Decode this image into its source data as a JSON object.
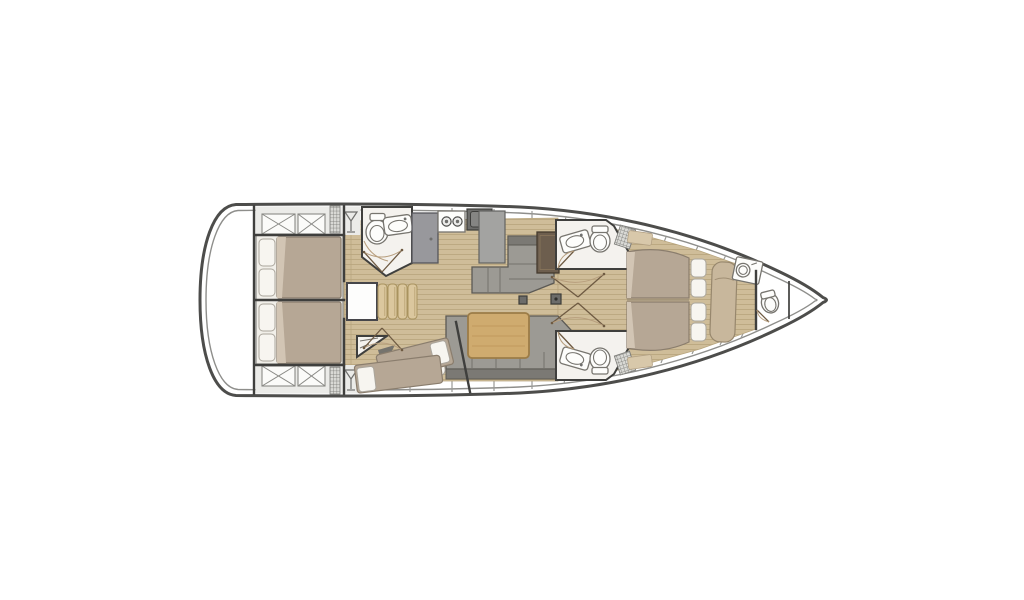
{
  "page": {
    "background": "#ffffff"
  },
  "diagram": {
    "type": "sailboat-interior-layout-floor-plan",
    "orientation": "bow-right",
    "features": [
      "hull-outline",
      "swim-platform-transom",
      "cockpit-locker-hatches",
      "aft-cabin-starboard-double-bed",
      "aft-cabin-port-double-bed",
      "aft-head-toilet-sink",
      "galley-stove-sink-counter",
      "refrigerator-cabinet",
      "companionway-steps",
      "engine-hatch",
      "starboard-settee",
      "sideboard-unit",
      "salon-sofa",
      "salon-table",
      "mid-cabin-two-single-berths",
      "wardrobe-corner",
      "forward-head-starboard",
      "forward-head-port",
      "shower-grates",
      "owner-cabin-island-double-bed",
      "owner-seat-chaise",
      "owner-vanity-sink",
      "bow-head-toilet",
      "forepeak-locker",
      "mast-step",
      "door-swings",
      "cockpit-grate",
      "cockpit-glass-holder"
    ],
    "counts": {
      "sleeping_cabins": 4,
      "double_beds": 3,
      "single_berths": 2,
      "toilets": 4,
      "sinks": 5,
      "stove_burners": 2,
      "companionway_steps": 4
    }
  },
  "colors": {
    "page-bg": "#ffffff",
    "hull-line": "#4d4d4b",
    "inner-line": "#8e8e8b",
    "wall": "#3f3f3d",
    "wood-floor": "#cfbd99",
    "wood-line": "#b7a47c",
    "mattress": "#b6a795",
    "mattress-edge": "#8a7d6d",
    "pillow": "#f7f5f0",
    "pillow-edge": "#aaa59c",
    "sofa": "#9c9a94",
    "sofa-dark": "#7b7974",
    "sofa-edge": "#5c5a55",
    "counter": "#a3a3a1",
    "counter-edge": "#626260",
    "appliance-dark": "#6c6c6a",
    "wood-table": "#cfab6f",
    "wood-table-edge": "#9c7c47",
    "step": "#dbc79e",
    "step-edge": "#a9935f",
    "tan-seat": "#c8b79c",
    "room-white": "#f4f2ee",
    "deck-band": "#ebebe8",
    "deck-line": "#9a9a97",
    "door-line": "#6e5a42",
    "dark-brown": "#6d5e4e",
    "fold": "#d2c5b4",
    "frame-white": "#f1efe9"
  }
}
